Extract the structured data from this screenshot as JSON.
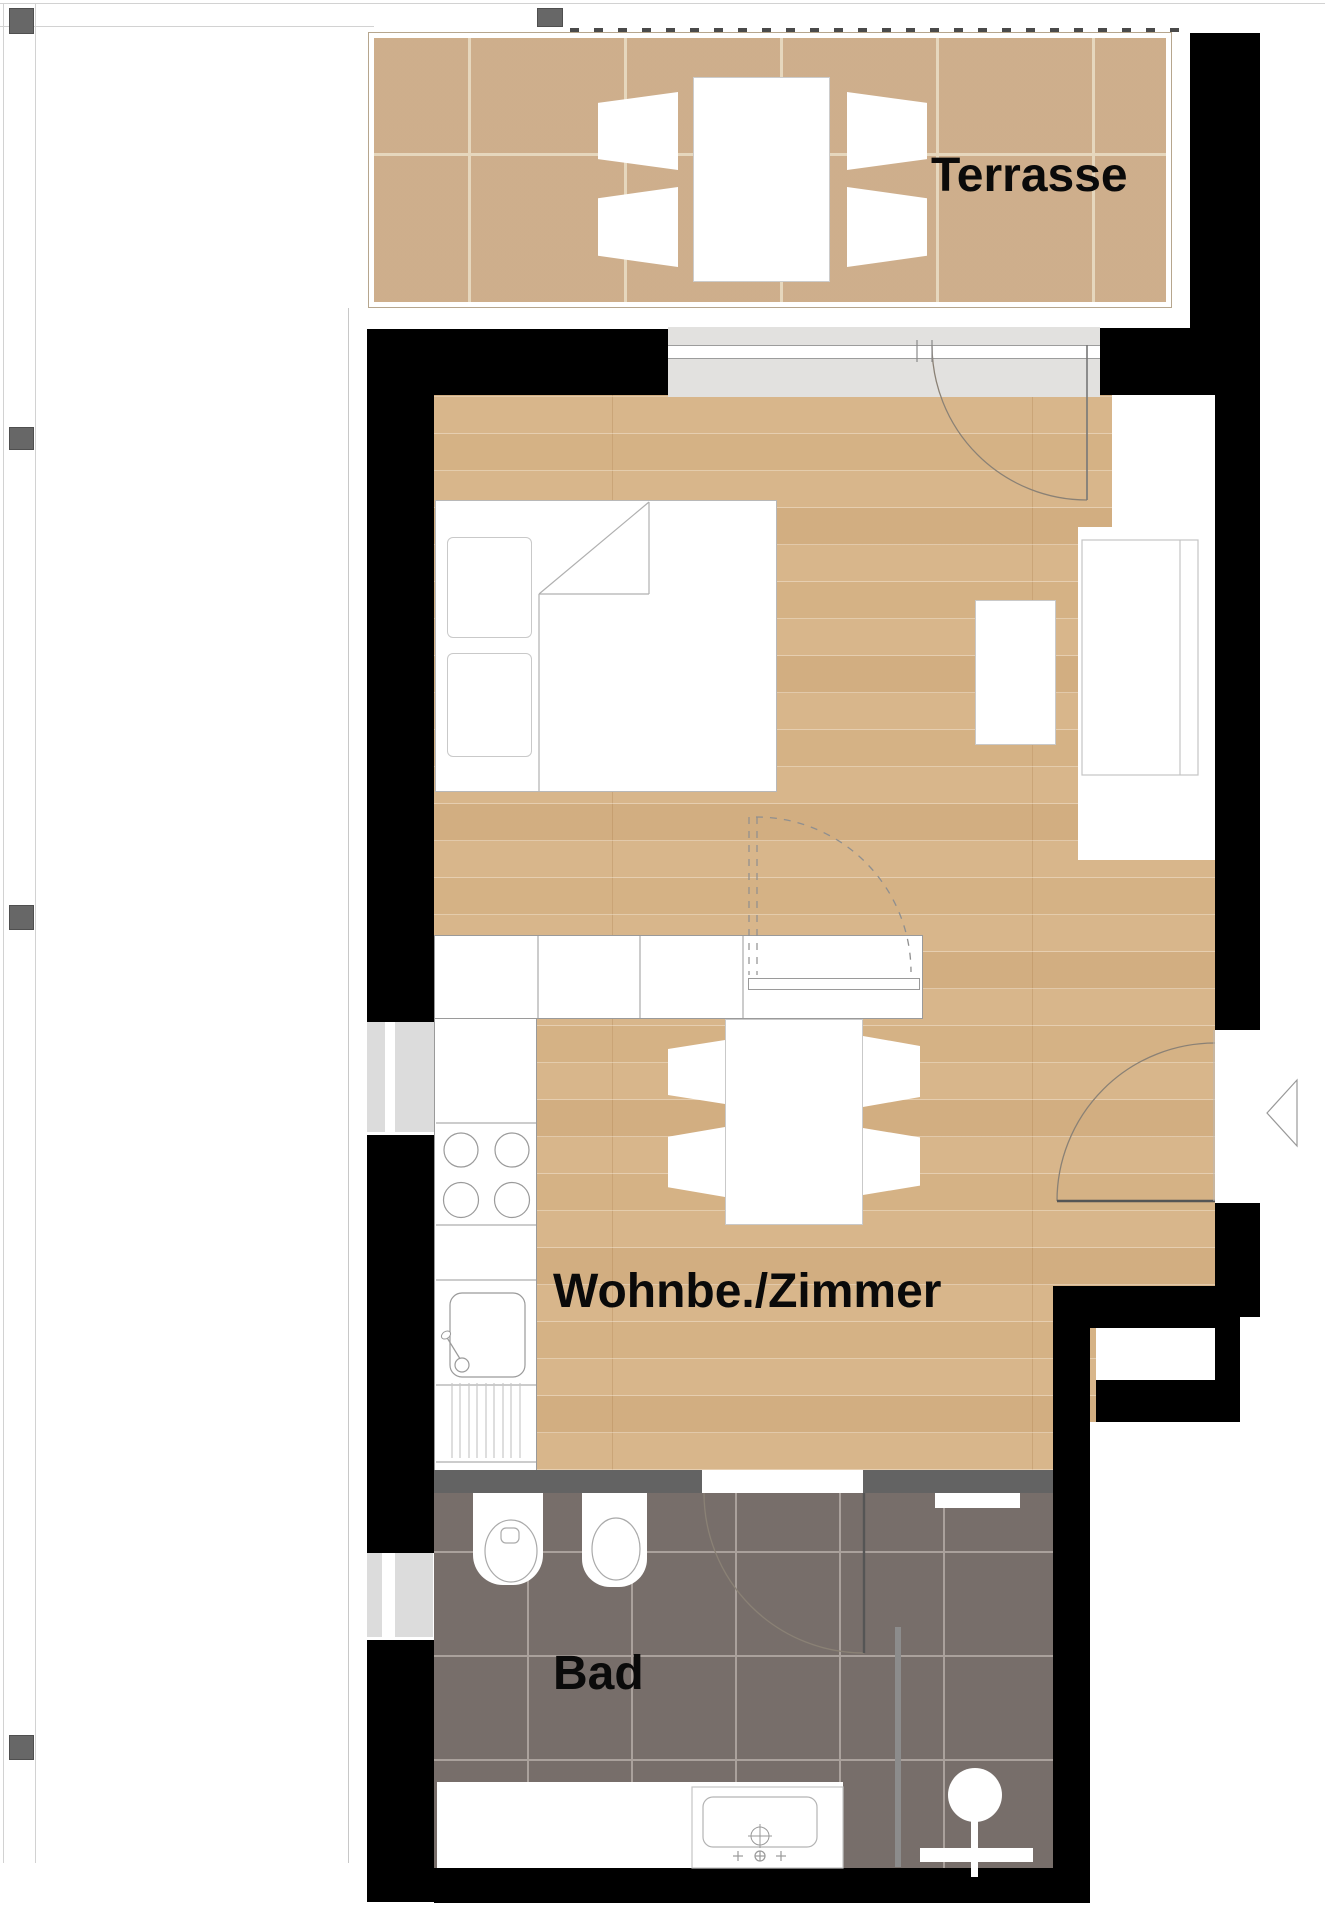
{
  "meta": {
    "type": "apartment-floor-plan",
    "width_px": 1325,
    "height_px": 1920
  },
  "rooms": [
    {
      "id": "terrasse",
      "label": "Terrasse",
      "floor": "ceramic-tile",
      "floor_color": "#d2b493"
    },
    {
      "id": "wohnzimmer",
      "label": "Wohnbe./Zimmer",
      "floor": "wood-parquet",
      "floor_color": "#d8b68b"
    },
    {
      "id": "bad",
      "label": "Bad",
      "floor": "dark-tile",
      "floor_color": "#7e7571"
    }
  ],
  "colors": {
    "wall": "#000000",
    "partition_wall": "#636363",
    "window_frame_fill": "#e2e1df",
    "window_glass_fill": "#dcdcdc",
    "column_marker": "#676767",
    "fixture_outline": "#9a9a9a",
    "door_arc": "#8a8175",
    "shower_glass": "#8c8c8c",
    "label_text": "#0a0a0a"
  },
  "furniture": {
    "terrasse": [
      "outdoor-table",
      "chair",
      "chair",
      "chair",
      "chair"
    ],
    "wohnzimmer": [
      "double-bed",
      "pillow",
      "pillow",
      "kitchen-counter",
      "cooktop-4-burners",
      "kitchen-sink",
      "dining-table",
      "chair",
      "chair",
      "chair",
      "chair",
      "side-table",
      "sideboard",
      "closet-niche"
    ],
    "bad": [
      "toilet",
      "bidet",
      "shower-head",
      "shower-glass",
      "washbasin",
      "bath-deck"
    ]
  },
  "annotations": {
    "entrance_arrow": "entrance",
    "door_swings": 4,
    "windows": 3
  }
}
